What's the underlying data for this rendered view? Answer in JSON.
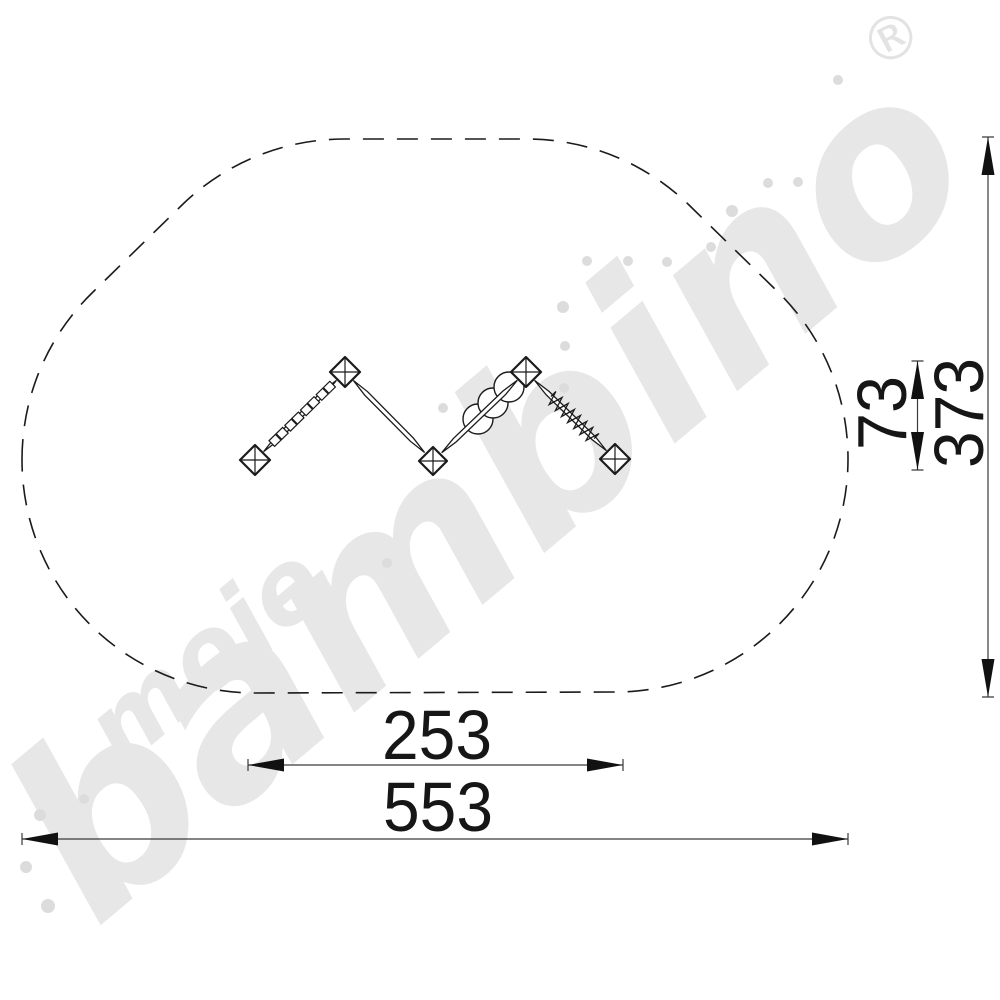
{
  "drawing": {
    "type": "playground-equipment-top-view-dimension-drawing",
    "dimensions": {
      "total_width_cm": "553",
      "inner_width_cm": "253",
      "total_depth_cm": "373",
      "inner_depth_cm": "73"
    },
    "safety_zone": {
      "outline_style": "dashed",
      "shape": "rounded-offset-oval"
    },
    "equipment": {
      "layout": "zigzag-balance-course",
      "post_count": 5,
      "segment_features": [
        "paired-step-rungs",
        "plain-beam",
        "disc-steps",
        "rope-coil"
      ]
    },
    "watermark": {
      "word_small": "moje",
      "word_large": "bambino",
      "registered_symbol": "®",
      "color": "#e7e7e7"
    },
    "colors": {
      "line": "#1b1b1b",
      "dimension_line": "#3a3a3a",
      "watermark_dots": "#dcdcdc",
      "background": "#ffffff"
    }
  }
}
